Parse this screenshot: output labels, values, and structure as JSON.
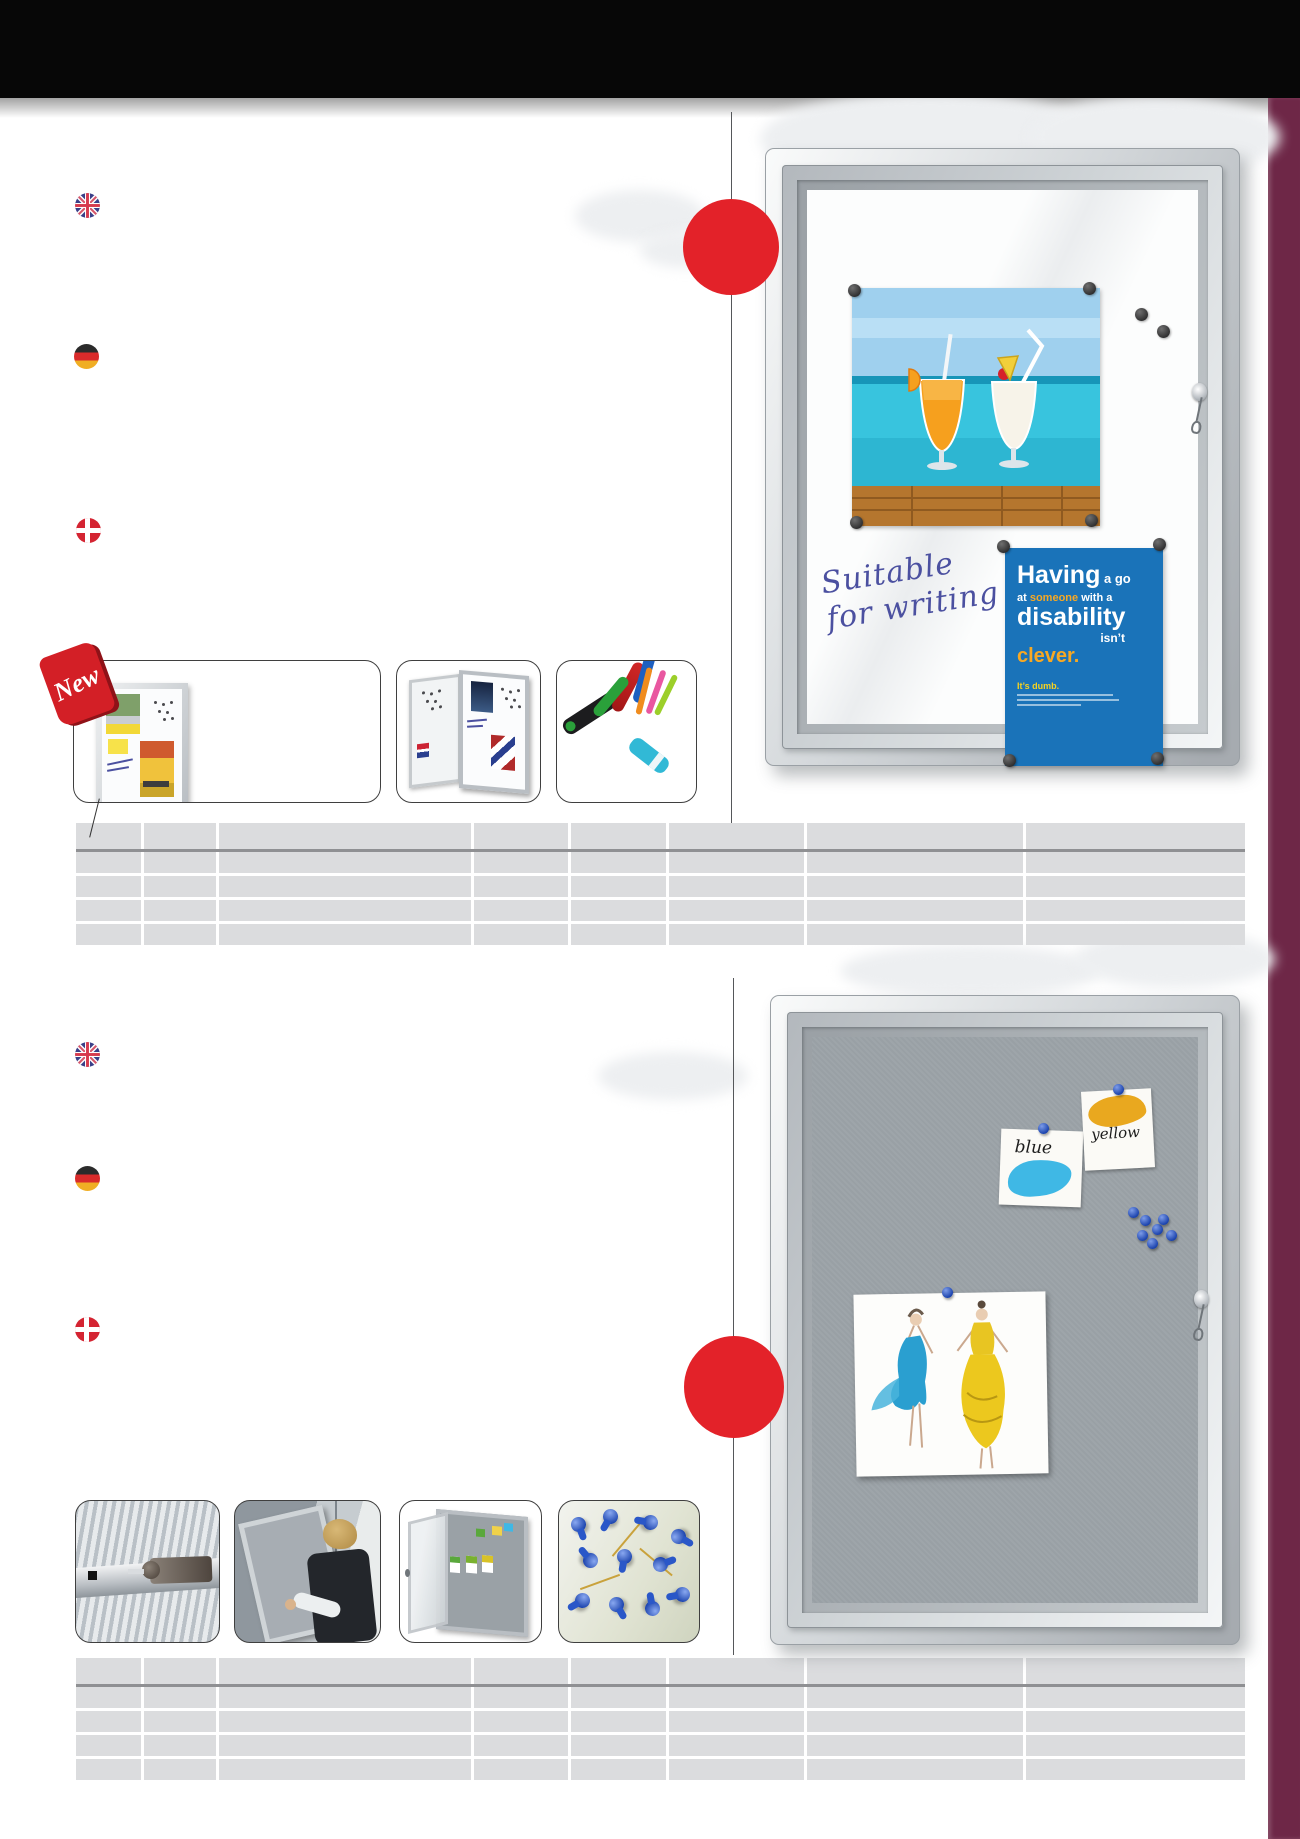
{
  "page": {
    "width": 1300,
    "height": 1839,
    "background": "#ffffff"
  },
  "chrome": {
    "header_bar_color": "#070707",
    "side_accent_color": "#6e2747",
    "accent_red": "#e32229",
    "table_cell_color": "#dbdcde"
  },
  "flags": {
    "uk": "united-kingdom",
    "germany": "germany",
    "denmark": "denmark"
  },
  "section1": {
    "new_badge_label": "New",
    "board_writing": {
      "line1": "Suitable",
      "line2": "for writing"
    },
    "poster": {
      "line1_big": "Having",
      "line1_small": " a go",
      "line2_pre": "at ",
      "line2_accent": "someone",
      "line2_post": " with a",
      "line3": "disability",
      "line4": "isn’t",
      "line5": "clever.",
      "tagline": "It’s dumb.",
      "bg_color": "#1a73b9",
      "accent_color": "#f7a823"
    },
    "table": {
      "columns": 8,
      "data_rows": 4
    }
  },
  "section2": {
    "sticky_notes": {
      "note1": "blue",
      "note2": "yellow"
    },
    "pin_color": "#2453c0",
    "felt_color": "#99a0a5",
    "table": {
      "columns": 8,
      "data_rows": 4
    }
  }
}
